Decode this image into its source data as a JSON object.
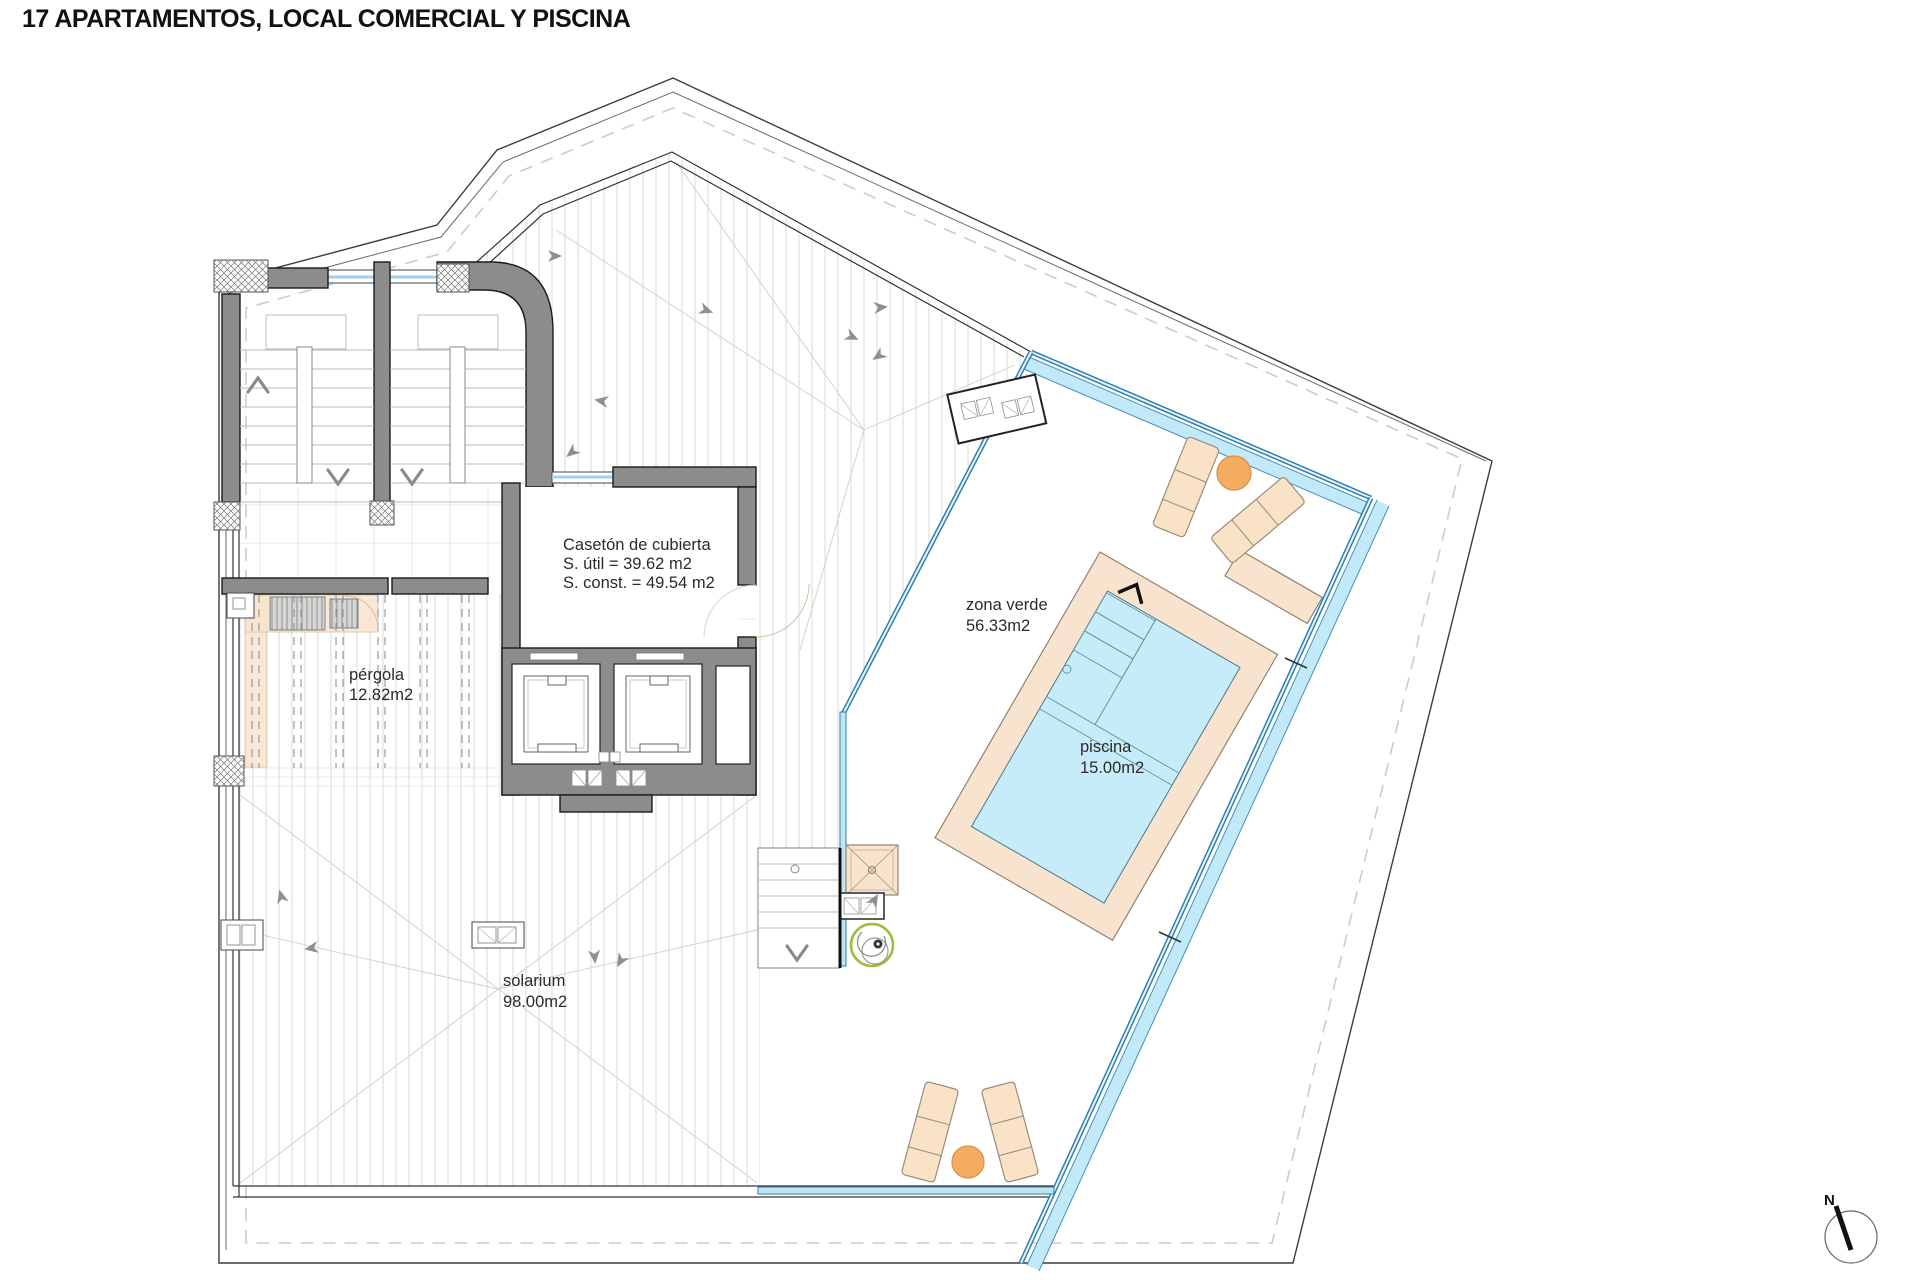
{
  "title": "17 APARTAMENTOS, LOCAL COMERCIAL Y PISCINA",
  "labels": {
    "caseton": [
      "Casetón de cubierta",
      "S. útil = 39.62 m2",
      "S. const. = 49.54 m2"
    ],
    "pergola": [
      "pérgola",
      "12.82m2"
    ],
    "zona_verde": [
      "zona verde",
      "56.33m2"
    ],
    "piscina": [
      "piscina",
      "15.00m2"
    ],
    "solarium": [
      "solarium",
      "98.00m2"
    ],
    "north": "N"
  },
  "colors": {
    "wall": "#8c8c8c",
    "deck": "#f8e4ce",
    "water": "#c6ecf9",
    "lounger": "#f9e2c6",
    "orange": "#f3ac62",
    "poolblue": "#2f7fae",
    "channelblue": "#c2e9f8",
    "glazing": "#9fd1e8",
    "green": "#9cbf3a",
    "hatch": "#d9d9d9"
  }
}
